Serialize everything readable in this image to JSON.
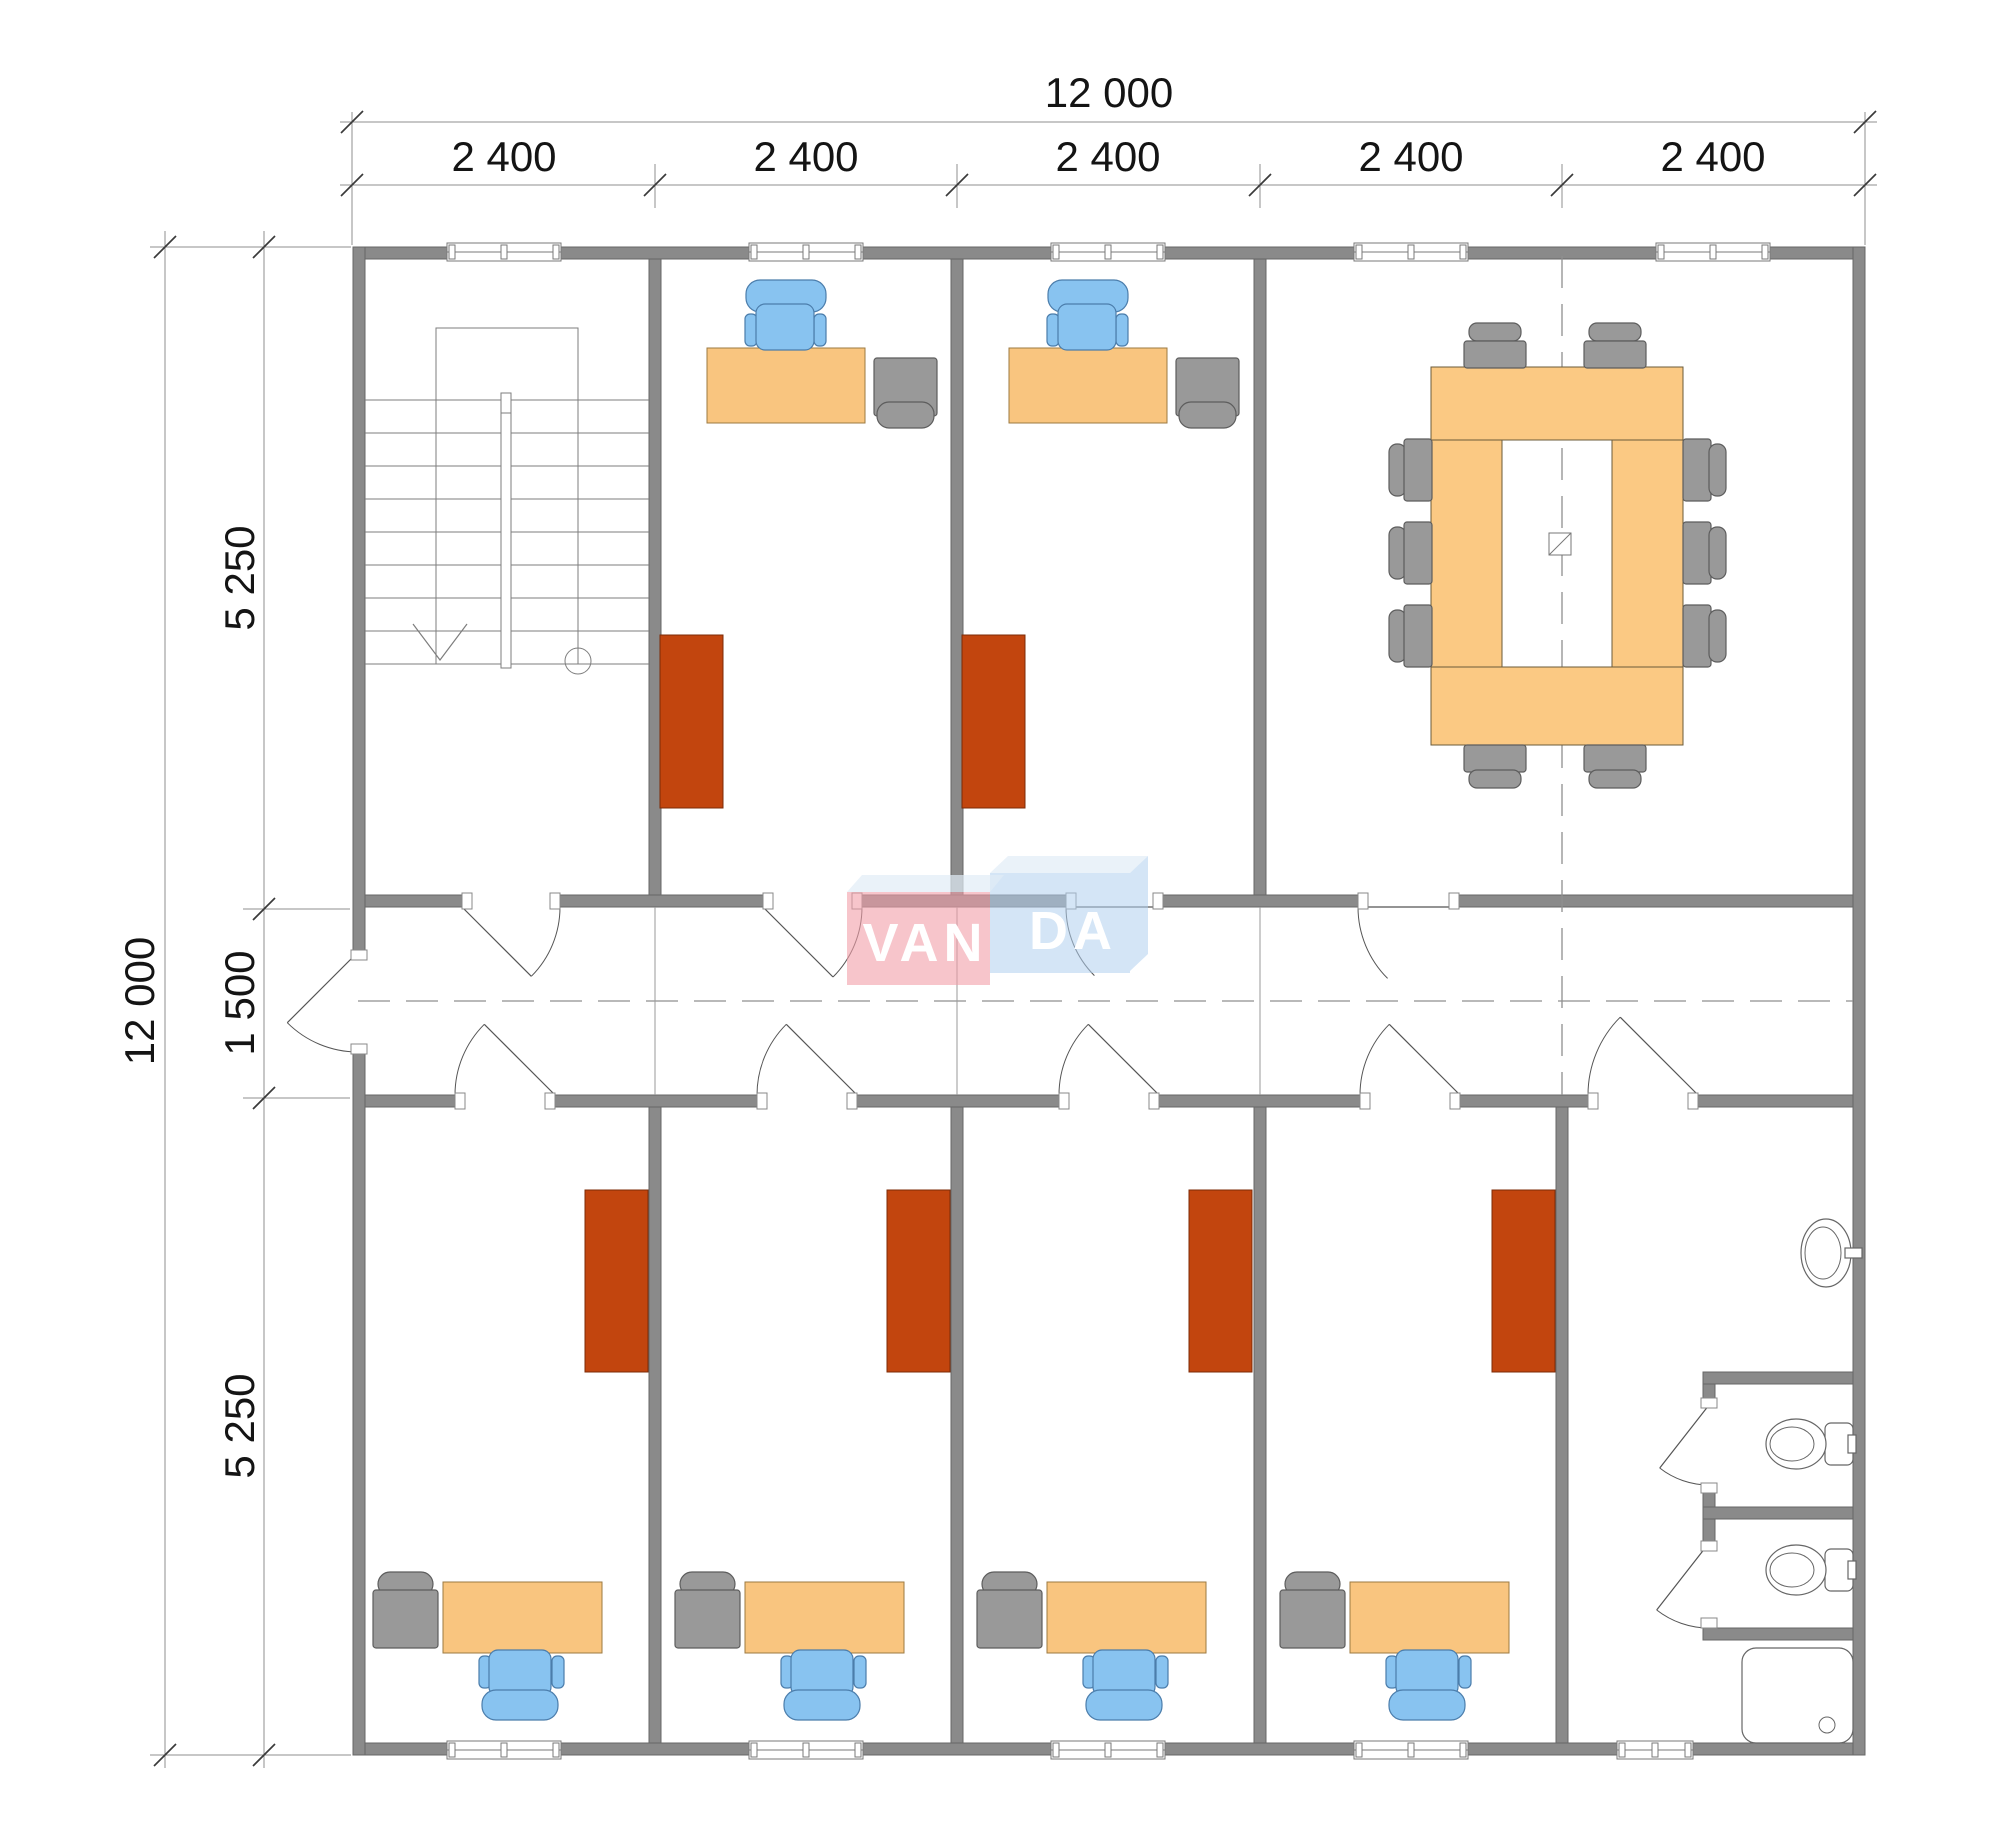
{
  "drawing": {
    "kind": "office floor plan",
    "logo": {
      "part1": "VAN",
      "part2": "DA"
    }
  },
  "logo": {
    "part1": "VAN",
    "part2": "DA"
  },
  "dimensions": {
    "top": {
      "total": "12 000",
      "segments": [
        "2 400",
        "2 400",
        "2 400",
        "2 400",
        "2 400"
      ]
    },
    "left": {
      "total": "12 000",
      "segments": [
        "5 250",
        "1 500",
        "5 250"
      ]
    }
  },
  "colors": {
    "wall": "#8a8a8a",
    "wall_edge": "#676767",
    "window_fill": "#ffffff",
    "window_edge": "#7a7a7a",
    "desk": "#f9c57f",
    "desk_edge": "#9c7a42",
    "table": "#fbc983",
    "table_edge": "#6b5b3a",
    "chair_blue": "#88c3f0",
    "chair_blue_edge": "#4b7dab",
    "chair_gray": "#999999",
    "chair_gray_edge": "#5d5d5d",
    "cabinet": "#c2450e",
    "cabinet_edge": "#7c2b07",
    "fixture_line": "#666666",
    "stair_line": "#7d7d7d",
    "axis_dash": "#8f8f8f",
    "door_line": "#555555",
    "dim_line": "#8f8f8f",
    "dim_tick": "#3a3a3a",
    "dim_text": "#141414",
    "logo_pink": "rgba(242,158,168,0.60)",
    "logo_blue": "rgba(176,208,238,0.55)",
    "logo_top": "rgba(225,236,247,0.70)",
    "logo_text": "#ffffff"
  }
}
